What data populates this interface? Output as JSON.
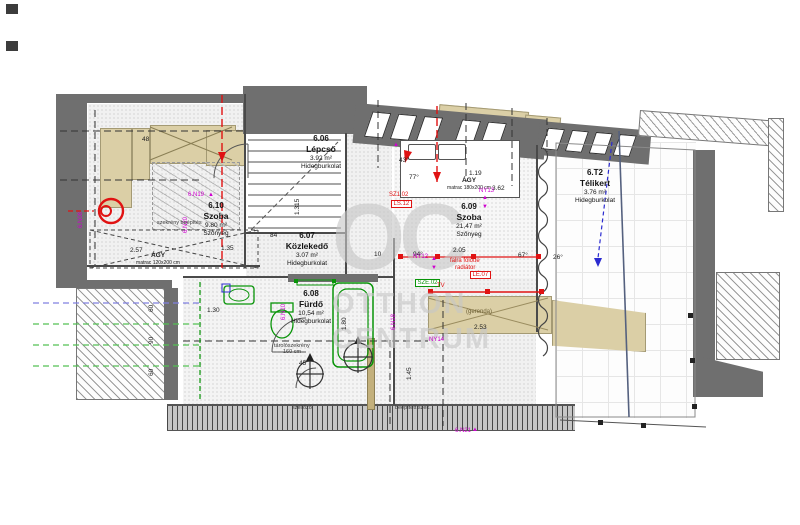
{
  "watermark": {
    "monogram": "OC",
    "line1": "OTTHON",
    "line2": "CENTRUM"
  },
  "rooms": {
    "r606": {
      "id": "6.06",
      "name": "Lépcső",
      "area": "3.92 m²",
      "finish": "Hidegburkolat"
    },
    "r607": {
      "id": "6.07",
      "name": "Közlekedő",
      "area": "3.07 m²",
      "finish": "Hidegburkolat"
    },
    "r608": {
      "id": "6.08",
      "name": "Fürdő",
      "area": "10,54 m²",
      "finish": "Hidegburkolat"
    },
    "r609": {
      "id": "6.09",
      "name": "Szoba",
      "area": "21,47 m²",
      "finish": "Szőnyeg"
    },
    "r610": {
      "id": "6.10",
      "name": "Szoba",
      "area": "9.80 m²",
      "finish": "Szőnyeg"
    },
    "rT2": {
      "id": "6.T2",
      "name": "Télikert",
      "area": "3.76 m²",
      "finish": "Hidegburkolat"
    }
  },
  "furniture": {
    "bed_big_label": "ÁGY",
    "bed_big_sub": "matrac 180x200 cm",
    "bed_small_label": "ÁGY",
    "bed_small_sub": "matrac 120x200 cm",
    "beam_label": "(gerenda)"
  },
  "dimensions": [
    {
      "t": "48",
      "x": 142,
      "y": 137
    },
    {
      "t": "43°",
      "x": 399,
      "y": 158
    },
    {
      "t": "77°",
      "x": 409,
      "y": 175
    },
    {
      "t": "1.19",
      "x": 469,
      "y": 171
    },
    {
      "t": "3.62",
      "x": 492,
      "y": 186
    },
    {
      "t": "1.315",
      "x": 295,
      "y": 215,
      "r": true
    },
    {
      "t": "84",
      "x": 270,
      "y": 233
    },
    {
      "t": "10",
      "x": 374,
      "y": 252
    },
    {
      "t": "94°",
      "x": 413,
      "y": 252
    },
    {
      "t": "2.05",
      "x": 453,
      "y": 248
    },
    {
      "t": "67°",
      "x": 518,
      "y": 253
    },
    {
      "t": "26°",
      "x": 553,
      "y": 255
    },
    {
      "t": "2.53",
      "x": 474,
      "y": 325
    },
    {
      "t": "1.80",
      "x": 342,
      "y": 330,
      "r": true
    },
    {
      "t": "1.45",
      "x": 407,
      "y": 380,
      "r": true
    },
    {
      "t": "45",
      "x": 299,
      "y": 361
    },
    {
      "t": "1.30",
      "x": 207,
      "y": 308
    },
    {
      "t": "1.35",
      "x": 221,
      "y": 246
    },
    {
      "t": "2.57",
      "x": 130,
      "y": 248
    },
    {
      "t": "60",
      "x": 149,
      "y": 312,
      "r": true
    },
    {
      "t": "90",
      "x": 149,
      "y": 344,
      "r": true
    },
    {
      "t": "60",
      "x": 149,
      "y": 376,
      "r": true
    }
  ],
  "annotations": [
    {
      "t": "SZ1.02",
      "x": 389,
      "y": 192,
      "c": "red"
    },
    {
      "t": "LS.12",
      "x": 391,
      "y": 200,
      "c": "red",
      "box": true
    },
    {
      "t": "NY12",
      "x": 413,
      "y": 254,
      "c": "mag"
    },
    {
      "t": "▲",
      "x": 431,
      "y": 256,
      "c": "mag"
    },
    {
      "t": "▼",
      "x": 431,
      "y": 265,
      "c": "mag"
    },
    {
      "t": "falra fölötte",
      "x": 450,
      "y": 258,
      "c": "red"
    },
    {
      "t": "radiátor",
      "x": 455,
      "y": 265,
      "c": "red"
    },
    {
      "t": "LÉ.07",
      "x": 470,
      "y": 271,
      "c": "red",
      "box": true
    },
    {
      "t": "SZE.02",
      "x": 415,
      "y": 279,
      "c": "grn",
      "box": true
    },
    {
      "t": "TV",
      "x": 437,
      "y": 283,
      "c": "red"
    },
    {
      "t": "NY13",
      "x": 479,
      "y": 188,
      "c": "mag"
    },
    {
      "t": "▲",
      "x": 482,
      "y": 195,
      "c": "mag"
    },
    {
      "t": "▼",
      "x": 482,
      "y": 204,
      "c": "mag"
    },
    {
      "t": "▲",
      "x": 393,
      "y": 142,
      "c": "mag"
    },
    {
      "t": "6.N19",
      "x": 188,
      "y": 192,
      "c": "mag"
    },
    {
      "t": "▲",
      "x": 208,
      "y": 192,
      "c": "mag"
    },
    {
      "t": "6.N20",
      "x": 183,
      "y": 233,
      "c": "mag",
      "r": true
    },
    {
      "t": "6.N08",
      "x": 78,
      "y": 228,
      "c": "mag",
      "r": true
    },
    {
      "t": "6.N10",
      "x": 281,
      "y": 320,
      "c": "mag",
      "r": true
    },
    {
      "t": "6.N18",
      "x": 391,
      "y": 330,
      "c": "mag",
      "r": true
    },
    {
      "t": "NY14",
      "x": 429,
      "y": 337,
      "c": "mag"
    },
    {
      "t": "6.N21",
      "x": 455,
      "y": 428,
      "c": "mag"
    },
    {
      "t": "▲",
      "x": 472,
      "y": 427,
      "c": "mag"
    },
    {
      "t": "szekrény beépítés",
      "x": 157,
      "y": 221,
      "c": "blk"
    },
    {
      "t": "tárolószekrény",
      "x": 274,
      "y": 344,
      "c": "blk"
    },
    {
      "t": "160 cm",
      "x": 283,
      "y": 350,
      "c": "blk"
    },
    {
      "t": "beépített szek.",
      "x": 395,
      "y": 406,
      "c": "blk"
    },
    {
      "t": "szellőző",
      "x": 292,
      "y": 406,
      "c": "blk"
    }
  ],
  "colors": {
    "wall": "#6f6f6f",
    "tan": "#dbcfa6",
    "red": "#e01212",
    "magenta": "#cf00cf",
    "green": "#089408",
    "blue_dash": "#2b2bd0",
    "watermark": "#c7c7c7"
  }
}
